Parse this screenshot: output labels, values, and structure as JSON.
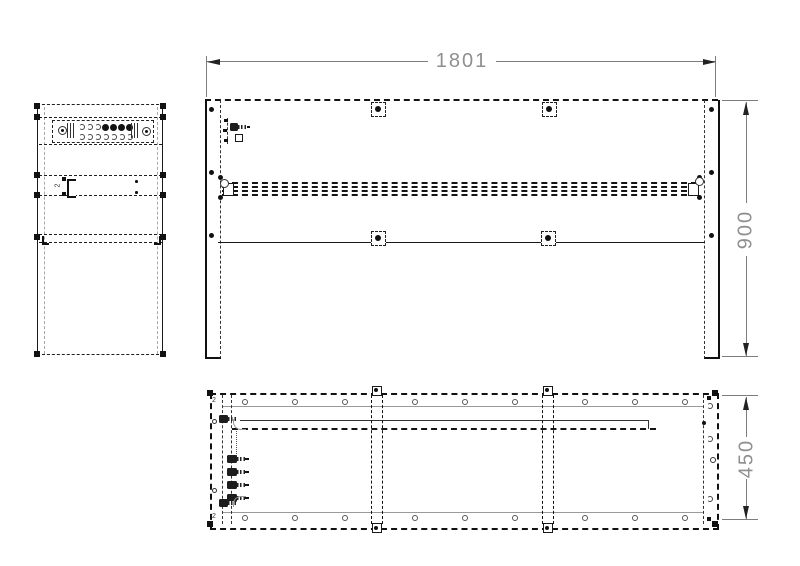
{
  "meta": {
    "type": "technical-drawing",
    "subject": "desk frame assembly, three orthographic views"
  },
  "colors": {
    "line": "#1a1a1a",
    "secondary_line": "#9a9a9a",
    "dimension": "#8f8f8f",
    "background": "#ffffff"
  },
  "dimensions": {
    "width": {
      "label": "1801",
      "orientation": "horizontal"
    },
    "height": {
      "label": "900",
      "orientation": "vertical"
    },
    "depth": {
      "label": "450",
      "orientation": "vertical"
    }
  },
  "annotations": {
    "qty": "2"
  }
}
